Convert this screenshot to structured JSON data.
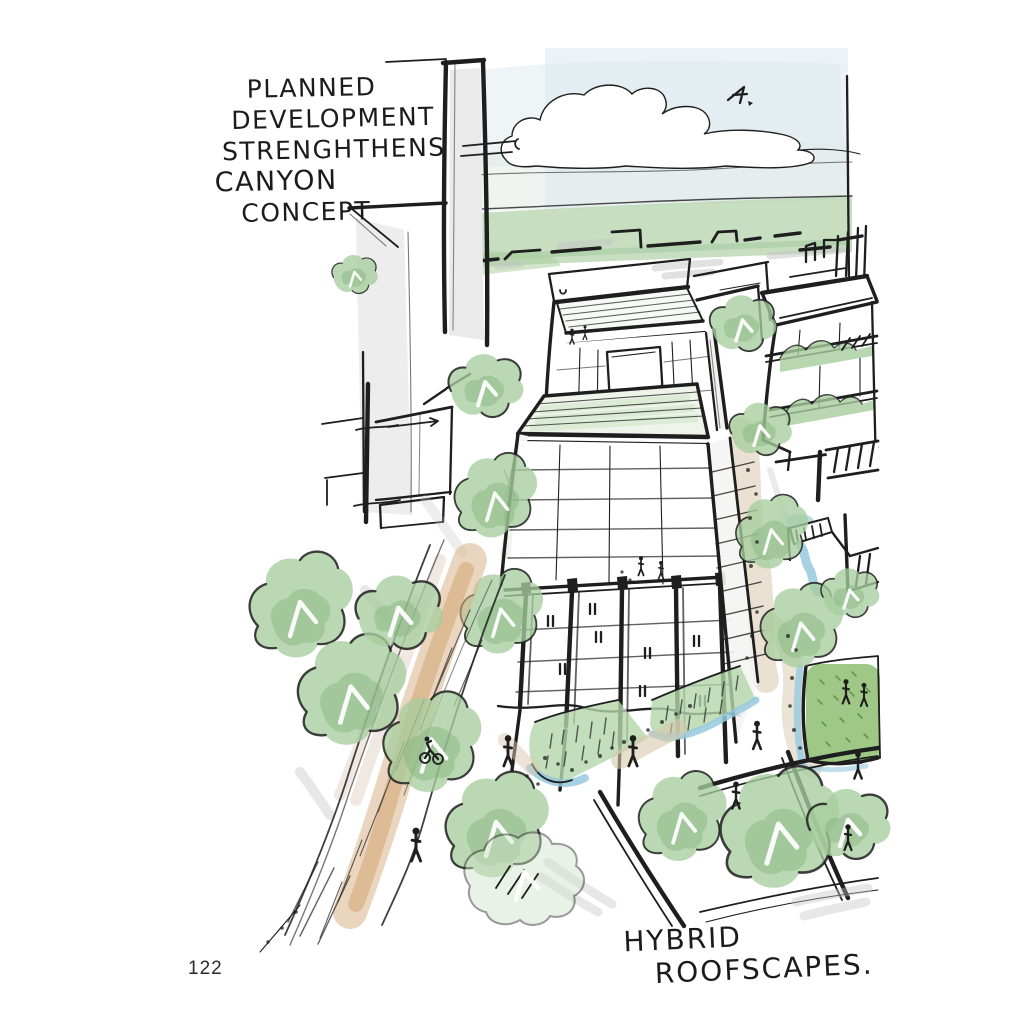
{
  "page": {
    "kind": "sketchbook page",
    "number": "122"
  },
  "annotations": {
    "top_left": {
      "lines": [
        "PLANNED",
        "DEVELOPMENT",
        "STRENGHTHENS",
        "CANYON",
        "CONCEPT"
      ]
    },
    "bottom_right": {
      "lines": [
        "HYBRID",
        "ROOFSCAPES."
      ]
    }
  },
  "sketch": {
    "description": "Aerial hand-drawn watercolor concept sketch: planned mid-rise development with hybrid planted roofscapes, canyon-like green street, bioswales, rooftop lawn with people, cyclist and pedestrians, distant skyline, cloud and bird",
    "colors": {
      "ink": "#1e1e1e",
      "sky": "#dce8ee",
      "horizonGreen": "#b9d6b2",
      "treeGreen": "#a6cd9d",
      "treeGreenDark": "#7cb077",
      "lawnGreen": "#95c27a",
      "waterBlue": "#96c9de",
      "pathTan": "#d8c8ae",
      "streetTan": "#d9b588",
      "washGrey": "#c4c4c4"
    }
  }
}
